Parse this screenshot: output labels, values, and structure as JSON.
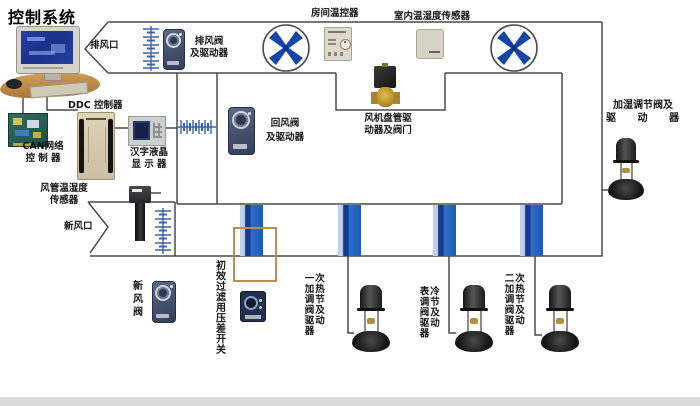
{
  "title": "控制系统",
  "colors": {
    "line": "#4a4a4a",
    "fan_blade_blue": "#1445a8",
    "louver_blue": "#3a62b0",
    "coil_bar_blue": "#1d5cb4",
    "coil_bar_navy": "#16388e",
    "filter_frame_tan": "#c08a50",
    "actuator_slate": "#414e6a",
    "brass": "#c9a133"
  },
  "icons": {
    "fan": "circle-with-x-blades",
    "louver": "line-with-cross-ticks",
    "flex-connector": "line-with-cross-ticks",
    "flow-arrow": "chevron"
  },
  "labels": {
    "exhaust_vent": "排风口",
    "exhaust_damper": {
      "lines": [
        "排风阀",
        "及驱动器"
      ]
    },
    "room_thermostat": "房间温控器",
    "indoor_sensor": "室内温湿度传感器",
    "ddc": "DDC 控制器",
    "can": {
      "lines": [
        "CAN网络",
        "控 制 器"
      ]
    },
    "lcd": {
      "lines": [
        "汉字液晶",
        "显 示 器"
      ]
    },
    "return_damper": {
      "lines": [
        "回风阀",
        "及驱动器"
      ]
    },
    "fan_coil": {
      "lines": [
        "风机盘管驱",
        "动器及阀门"
      ]
    },
    "humidify_valve": {
      "lines": [
        "加湿调节阀及",
        "驱 动 器"
      ]
    },
    "duct_sensor": {
      "lines": [
        "风管温湿度",
        "传感器"
      ]
    },
    "fresh_vent": "新风口",
    "fresh_damper": "新风阀",
    "filter_switch": "初效过滤用压差开关",
    "preheat_valve": {
      "reading": "一次加热调节阀及驱动器",
      "columns": [
        "一加调阀驱器",
        "次热节及动"
      ]
    },
    "cooling_valve": {
      "reading": "表冷调节阀及驱动器",
      "columns": [
        "表调阀驱器",
        "冷节及动"
      ]
    },
    "reheat_valve": {
      "reading": "二次加热调节阀及驱动器",
      "columns": [
        "二加调阀驱器",
        "次热节及动"
      ]
    }
  }
}
